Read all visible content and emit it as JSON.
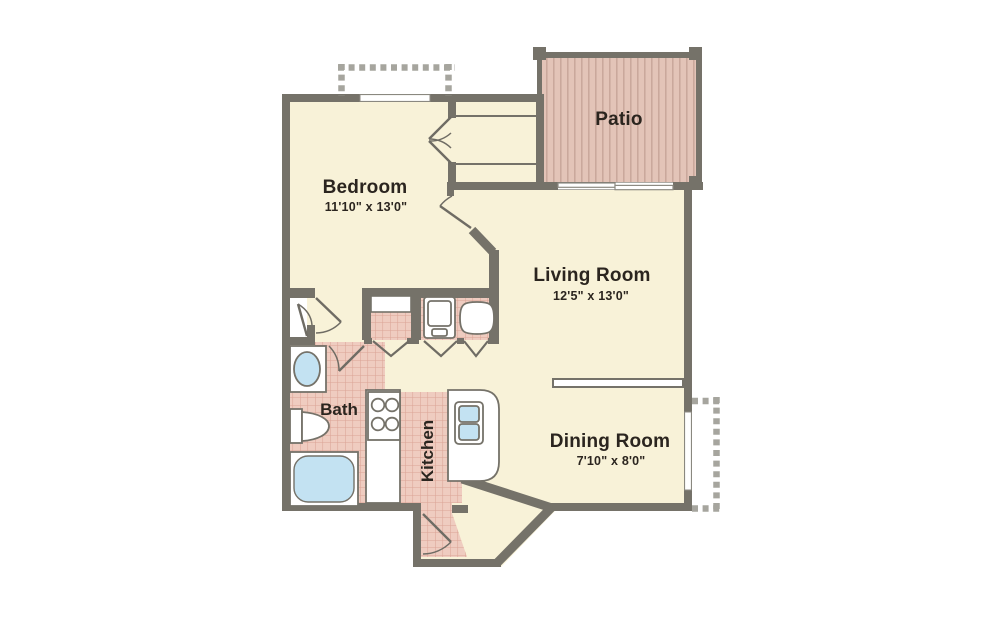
{
  "rooms": {
    "bedroom": {
      "name": "Bedroom",
      "dimensions": "11'10\" x 13'0\""
    },
    "living_room": {
      "name": "Living Room",
      "dimensions": "12'5\" x 13'0\""
    },
    "dining_room": {
      "name": "Dining Room",
      "dimensions": "7'10\" x 8'0\""
    },
    "patio": {
      "name": "Patio"
    },
    "bath": {
      "name": "Bath"
    },
    "kitchen": {
      "name": "Kitchen"
    }
  },
  "colors": {
    "floor_cream": "#F8F2D8",
    "tile_fill": "#EFCCC0",
    "tile_line": "#DBA496",
    "deck_fill": "#E3C4B8",
    "deck_stripe": "#C9A69A",
    "wall_gray": "#757269",
    "dash_gray": "#A6A59E",
    "fixture_blue": "#C3E2F2",
    "label_dark": "#2B251F"
  }
}
